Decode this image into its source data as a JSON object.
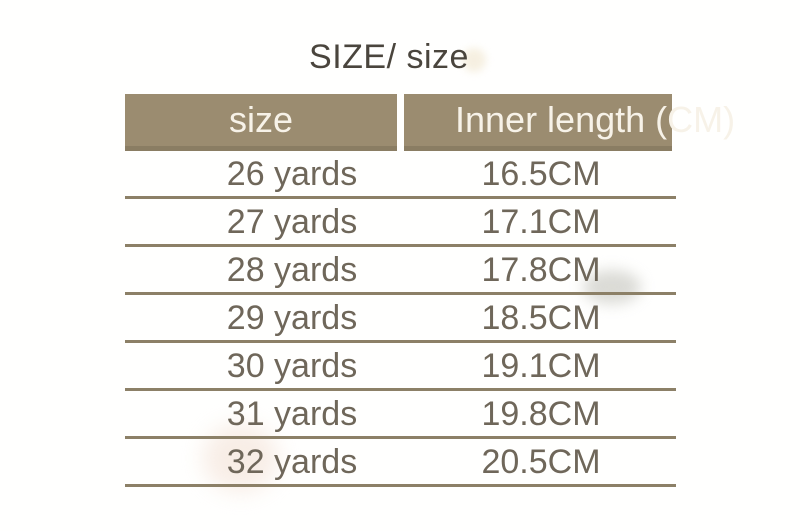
{
  "chart_data": {
    "type": "table",
    "title": "SIZE/ size",
    "columns": [
      "size",
      "Inner length (CM)"
    ],
    "rows": [
      [
        "26 yards",
        "16.5CM"
      ],
      [
        "27 yards",
        "17.1CM"
      ],
      [
        "28 yards",
        "17.8CM"
      ],
      [
        "29 yards",
        "18.5CM"
      ],
      [
        "30 yards",
        "19.1CM"
      ],
      [
        "31 yards",
        "19.8CM"
      ],
      [
        "32 yards",
        "20.5CM"
      ]
    ],
    "layout_hints": {
      "header_fill": true,
      "row_separators": true,
      "right_header_text_overflows_background": true
    }
  },
  "colors": {
    "background": "#fffffe",
    "header-bg": "#9b8c70",
    "header-bg-edge": "#8a7d63",
    "header-text": "#f7f2e8",
    "line": "#8c8067",
    "body-text": "#6f675a",
    "title-text": "#4a453d"
  }
}
